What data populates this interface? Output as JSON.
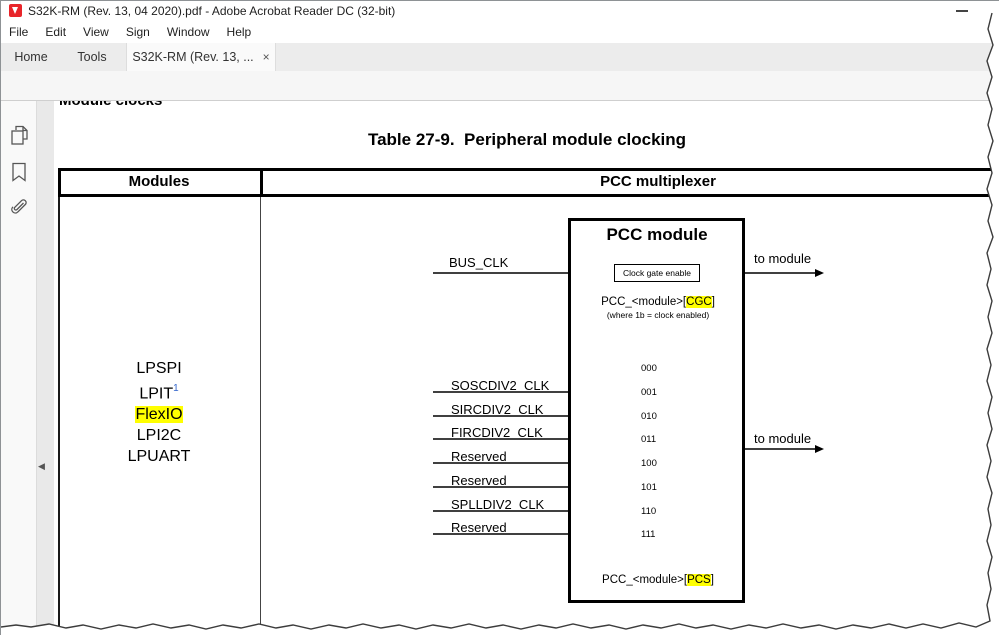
{
  "window": {
    "title": "S32K-RM (Rev. 13, 04 2020).pdf - Adobe Acrobat Reader DC (32-bit)"
  },
  "menu": {
    "items": [
      "File",
      "Edit",
      "View",
      "Sign",
      "Window",
      "Help"
    ]
  },
  "tabs": {
    "home": "Home",
    "tools": "Tools",
    "document": "S32K-RM (Rev. 13, ...",
    "close": "×"
  },
  "toolbar": {
    "page_current": "568",
    "page_total": "/ 2179",
    "zoom_level": "150%"
  },
  "icons": [
    "adobe-pdf-logo",
    "minimize",
    "save",
    "star",
    "print",
    "email",
    "search",
    "page-up",
    "page-down",
    "select-tool",
    "hand-tool",
    "zoom-out",
    "zoom-in",
    "fit-width",
    "scrolling-mode",
    "page-thumbnails",
    "bookmarks",
    "attachments",
    "collapse-pane",
    "close-tab"
  ],
  "colors": {
    "highlight_yellow": "#ffff00",
    "footnote_blue": "#3366cc",
    "select_tool_blue": "#2577d4",
    "pdf_logo_red": "#e8252a"
  },
  "document": {
    "clipped_heading": "Module clocks",
    "table_title": "Table 27-9.  Peripheral module clocking",
    "table": {
      "col1_header": "Modules",
      "col2_header": "PCC multiplexer"
    },
    "modules": {
      "items": [
        "LPSPI",
        "LPIT",
        "FlexIO",
        "LPI2C",
        "LPUART"
      ],
      "footnote_ref": "1",
      "highlighted": "FlexIO"
    },
    "diagram": {
      "box_title": "PCC module",
      "bus_clk": "BUS_CLK",
      "clock_gate": "Clock gate enable",
      "to_module_top": "to module",
      "to_module_bottom": "to module",
      "cgc_label": {
        "prefix": "PCC_<module>[",
        "highlight": "CGC",
        "suffix": "]"
      },
      "cgc_note": "(where 1b = clock enabled)",
      "pcs_label": {
        "prefix": "PCC_<module>[",
        "highlight": "PCS",
        "suffix": "]"
      },
      "inputs": [
        {
          "label": "",
          "code": "000"
        },
        {
          "label": "SOSCDIV2_CLK",
          "code": "001"
        },
        {
          "label": "SIRCDIV2_CLK",
          "code": "010"
        },
        {
          "label": "FIRCDIV2_CLK",
          "code": "011"
        },
        {
          "label": "Reserved",
          "code": "100"
        },
        {
          "label": "Reserved",
          "code": "101"
        },
        {
          "label": "SPLLDIV2_CLK",
          "code": "110"
        },
        {
          "label": "Reserved",
          "code": "111"
        }
      ]
    }
  }
}
